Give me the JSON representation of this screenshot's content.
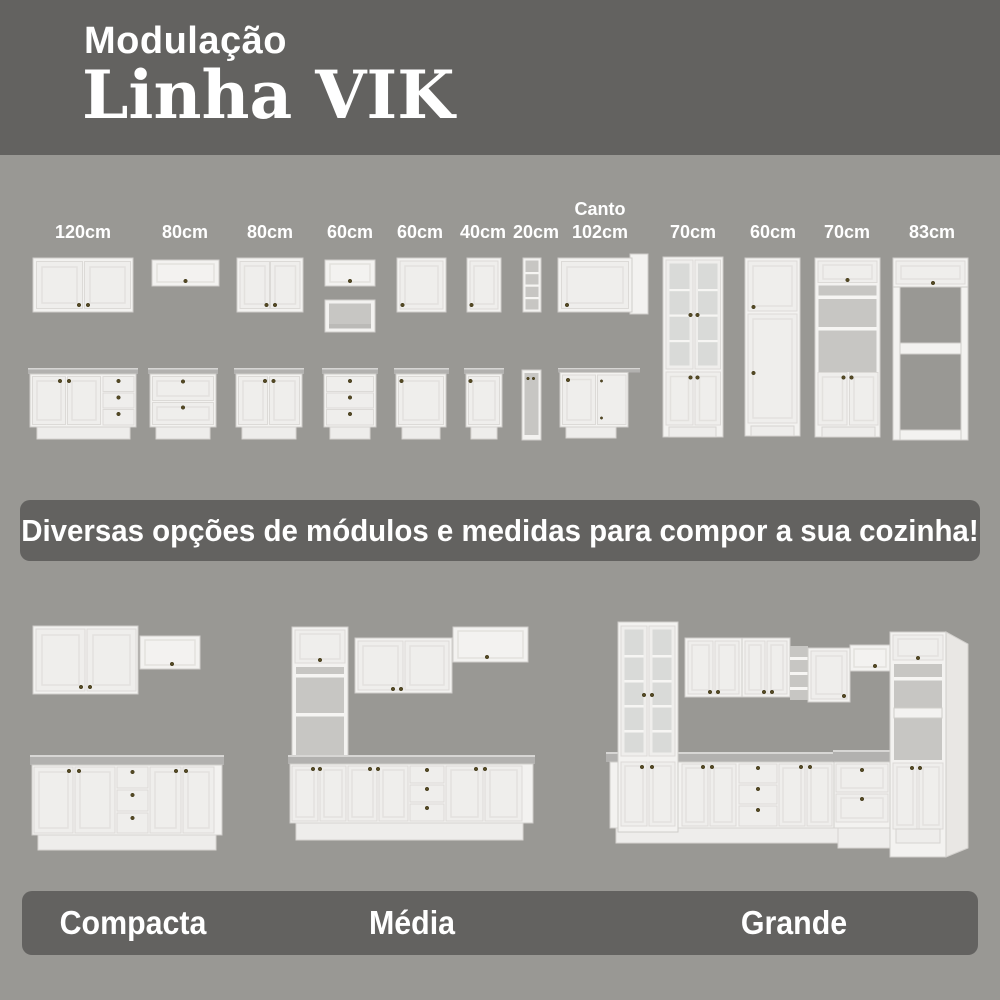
{
  "header": {
    "subtitle": "Modulação",
    "title": "Linha VIK"
  },
  "modules": [
    {
      "label": "120cm"
    },
    {
      "label": "80cm"
    },
    {
      "label": "80cm"
    },
    {
      "label": "60cm"
    },
    {
      "label": "60cm"
    },
    {
      "label": "40cm"
    },
    {
      "label": "20cm"
    },
    {
      "sublabel": "Canto",
      "label": "102cm"
    },
    {
      "label": "70cm"
    },
    {
      "label": "60cm"
    },
    {
      "label": "70cm"
    },
    {
      "label": "83cm"
    }
  ],
  "banner": {
    "text": "Diversas opções de módulos e medidas para compor a sua cozinha!"
  },
  "kitchens": [
    {
      "label": "Compacta"
    },
    {
      "label": "Média"
    },
    {
      "label": "Grande"
    }
  ],
  "colors": {
    "background": "#999894",
    "banner": "#636260",
    "text": "#ffffff",
    "cabinet": "#f3f2f0",
    "countertop": "#b2b1af",
    "knob": "#554a24"
  }
}
